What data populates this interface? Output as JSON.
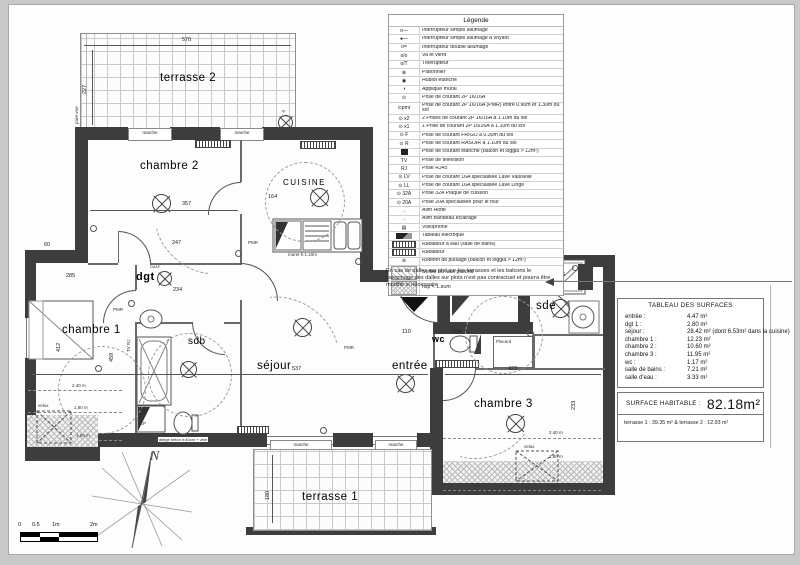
{
  "drawing": {
    "legend": {
      "title": "Légende",
      "rows": [
        {
          "sym": "o—",
          "cls": "",
          "label": "Interrupteur simple allumage"
        },
        {
          "sym": "●—",
          "cls": "",
          "label": "Interrupteur simple allumage à voyant"
        },
        {
          "sym": "o=",
          "cls": "",
          "label": "Interrupteur double allumage"
        },
        {
          "sym": "o/o",
          "cls": "",
          "label": "Va et vient"
        },
        {
          "sym": "o/T",
          "cls": "",
          "label": "Télérupteur"
        },
        {
          "sym": "⊗",
          "cls": "",
          "label": "Plafonnier"
        },
        {
          "sym": "◉",
          "cls": "",
          "label": "Hublot étanche"
        },
        {
          "sym": "◑",
          "cls": "",
          "label": "Applique mural"
        },
        {
          "sym": "⊙",
          "cls": "",
          "label": "Prise de courant 2P 16/16A"
        },
        {
          "sym": "⊙pmr",
          "cls": "tall",
          "label": "Prise de courant 2P 16/16A (PMR) entre 0.90m et 1.30m du sol"
        },
        {
          "sym": "⊙ x2",
          "cls": "",
          "label": "2 Prises de courant 2P 16/16A à 1.10m du sol"
        },
        {
          "sym": "⊙ x1",
          "cls": "",
          "label": "1 Prise de courant 2P 16/16A à 1.10m du sol"
        },
        {
          "sym": "⊙ F",
          "cls": "",
          "label": "Prise de courant FRIGO à 0.30m du sol"
        },
        {
          "sym": "⊙ R",
          "cls": "",
          "label": "Prise de courant RASOIR à 1.10m du sol"
        },
        {
          "sym": "",
          "cls": "blacksq",
          "label": "Prise de courant étanche (balcon et loggia > 12m²)"
        },
        {
          "sym": "TV",
          "cls": "",
          "label": "Prise de télévision"
        },
        {
          "sym": "RJ",
          "cls": "",
          "label": "Prise RJ45"
        },
        {
          "sym": "⊙ LV",
          "cls": "",
          "label": "Prise de courant 16A spécialisée Lave Vaisselle"
        },
        {
          "sym": "⊙ LL",
          "cls": "",
          "label": "Prise de courant 16A spécialisée Lave Linge"
        },
        {
          "sym": "⊙ 32A",
          "cls": "",
          "label": "Prise 32A Plaque de cuisson"
        },
        {
          "sym": "⊙ 20A",
          "cls": "",
          "label": "Prise 20A spécialisée pour le four"
        },
        {
          "sym": "→",
          "cls": "",
          "label": "Alim Hotte"
        },
        {
          "sym": "→",
          "cls": "",
          "label": "Alim Bandeau éclairage"
        },
        {
          "sym": "▤",
          "cls": "",
          "label": "Visiophone"
        },
        {
          "sym": "",
          "cls": "darksq",
          "label": "Tableau électrique"
        },
        {
          "sym": "",
          "cls": "hatchbar",
          "label": "Radiateur à eau (salle de bains)"
        },
        {
          "sym": "",
          "cls": "hatchbar",
          "label": "Radiateur"
        },
        {
          "sym": "⊚",
          "cls": "",
          "label": "Robinet de puisage (balcon et loggia > 12m²)"
        },
        {
          "sym": "",
          "cls": "hatchsq tall",
          "label": "Soffite ou faux plafond"
        },
        {
          "sym": "",
          "cls": "dotsq tall",
          "label": "hsp < 1.80m"
        }
      ]
    },
    "note": "En cas de dalles sur plot sur les terrasses et les balcons le calepinage des dalles sur plots n'est pas contractuel et pourra être modifié si nécessaire",
    "surfaces": {
      "title": "TABLEAU DES SURFACES",
      "rows": [
        {
          "name": "entrée :",
          "value": "4.47 m²"
        },
        {
          "name": "dgt 1 :",
          "value": "2.80 m²"
        },
        {
          "name": "séjour :",
          "value": "28.42 m² (dont 6.53m² dans la cuisine)"
        },
        {
          "name": "chambre 1 :",
          "value": "12.23 m²"
        },
        {
          "name": "chambre 2 :",
          "value": "10.60 m²"
        },
        {
          "name": "chambre 3 :",
          "value": "11.95 m²"
        },
        {
          "name": "wc :",
          "value": "1.17 m²"
        },
        {
          "name": "salle de bains :",
          "value": "7.21 m²"
        },
        {
          "name": "salle d'eau :",
          "value": "3.33 m²"
        }
      ]
    },
    "habitable": {
      "label": "SURFACE HABITABLE :",
      "value": "82.18m²"
    },
    "terraces": "terrasse 1 : 39.35 m² & terrasse 2 : 12.93 m²",
    "rooms": {
      "terrasse2": "terrasse 2",
      "chambre2": "chambre 2",
      "cuisine": "CUISINE",
      "dgt": "dgt",
      "chambre1": "chambre 1",
      "sdb": "sdb",
      "sejour": "séjour",
      "entree": "entrée",
      "wc": "wc",
      "sde": "sde",
      "placard": "Placard",
      "chambre3": "chambre 3",
      "terrasse1": "terrasse 1"
    },
    "labels": {
      "pare_vue": "pare-vue",
      "marche": "marche",
      "velux": "velux",
      "muret": "muret h:1.10m",
      "daaf": "DAAF",
      "pmr": "PMR",
      "allege": "allège béton h:40cm + vitre",
      "ep": "EP",
      "tv_rj": "TV RJ",
      "rp": "rp"
    },
    "dims": {
      "d570": "570",
      "d227": "227",
      "d357": "357",
      "d285": "285",
      "d247": "247",
      "d60": "60",
      "d537": "537",
      "d459": "459",
      "d412": "412",
      "d234": "234",
      "d164": "164",
      "d110": "110",
      "d108": "108",
      "d126": "126",
      "d423": "423",
      "d233": "233",
      "d180": "180",
      "heights": [
        "2.40 m",
        "1.80 m",
        "1.00 m"
      ]
    },
    "scale": {
      "t0": "0",
      "t05": "0.5",
      "t1": "1m",
      "t2": "2m"
    },
    "compass": {
      "north": "N"
    }
  }
}
